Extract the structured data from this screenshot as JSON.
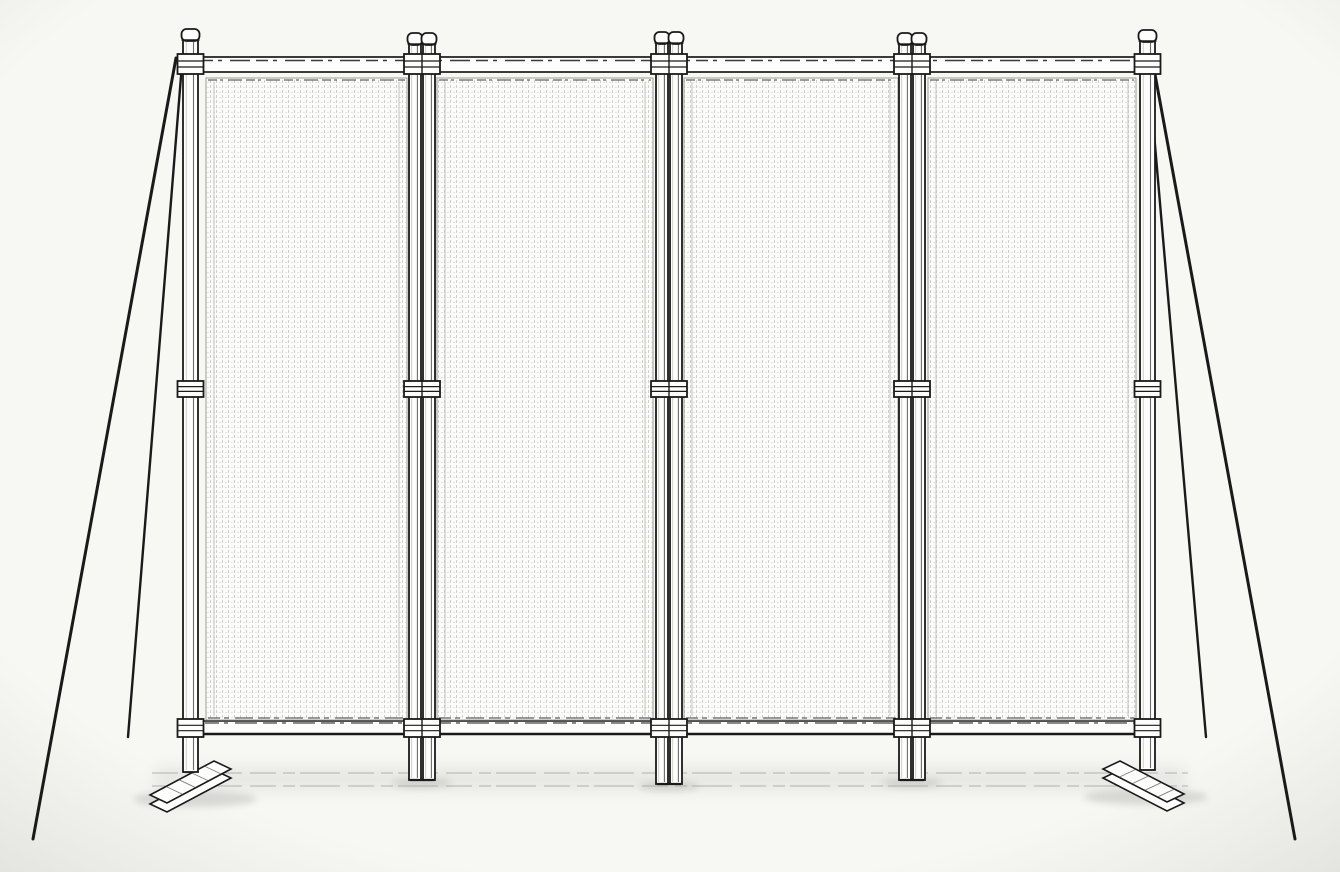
{
  "scene": {
    "subject": "Line drawing of a freestanding four-panel privacy screen fence with twin intermediate posts, corner guy wires and flat T-feet",
    "canvas": {
      "width": 1340,
      "height": 872
    },
    "colors": {
      "background": "#f7f7f4",
      "background_edge": "#a8a89e",
      "ink": "#1a1a1a",
      "ink_soft": "#3c3c3c",
      "metal_fill": "#fdfdfc",
      "panel_fill": "#fcfcfa",
      "mesh_dot": "#cfcfcb",
      "mesh_dot_light": "#e2e2de",
      "panel_border": "#9b9b97",
      "hem_line": "#c2c2be",
      "ground_line": "#a8a8a4",
      "shadow": "#9c9c98"
    },
    "structure": {
      "top_rail": {
        "x1": 197,
        "x2": 1143,
        "y": 57,
        "height": 15
      },
      "bottom_rail": {
        "x1": 201,
        "x2": 1139,
        "y": 721,
        "height": 13
      },
      "panels": [
        {
          "x1": 206,
          "x2": 407,
          "y1": 78,
          "y2": 720
        },
        {
          "x1": 437,
          "x2": 653,
          "y1": 78,
          "y2": 720
        },
        {
          "x1": 684,
          "x2": 898,
          "y1": 78,
          "y2": 720
        },
        {
          "x1": 928,
          "x2": 1136,
          "y1": 78,
          "y2": 720
        }
      ],
      "posts": [
        {
          "id": "left-end",
          "type": "single",
          "x": 183,
          "width": 15,
          "cap_y": 27,
          "bottom_y": 772
        },
        {
          "id": "middle-1",
          "type": "twin",
          "x": 409,
          "width": 26,
          "cap_y": 31,
          "bottom_y": 780
        },
        {
          "id": "middle-2",
          "type": "twin",
          "x": 656,
          "width": 26,
          "cap_y": 30,
          "bottom_y": 784
        },
        {
          "id": "middle-3",
          "type": "twin",
          "x": 899,
          "width": 26,
          "cap_y": 31,
          "bottom_y": 780
        },
        {
          "id": "right-end",
          "type": "single",
          "x": 1140,
          "width": 15,
          "cap_y": 28,
          "bottom_y": 770
        }
      ],
      "clamp_rows": [
        {
          "y": 54,
          "h": 20
        },
        {
          "y": 381,
          "h": 16
        },
        {
          "y": 719,
          "h": 18
        }
      ],
      "guy_wires": [
        {
          "id": "left-outer",
          "x1": 176,
          "y1": 58,
          "x2": 33,
          "y2": 839
        },
        {
          "id": "left-inner",
          "x1": 182,
          "y1": 64,
          "x2": 128,
          "y2": 737
        },
        {
          "id": "right-outer",
          "x1": 1152,
          "y1": 58,
          "x2": 1295,
          "y2": 839
        },
        {
          "id": "right-inner",
          "x1": 1148,
          "y1": 64,
          "x2": 1206,
          "y2": 737
        }
      ],
      "feet": [
        {
          "id": "left",
          "top_face": [
            [
              150,
              795
            ],
            [
              214,
              761
            ],
            [
              231,
              769
            ],
            [
              167,
              803
            ]
          ],
          "thickness": 9
        },
        {
          "id": "right",
          "top_face": [
            [
              1120,
              761
            ],
            [
              1184,
              794
            ],
            [
              1167,
              802
            ],
            [
              1103,
              769
            ]
          ],
          "thickness": 9
        }
      ],
      "ground": {
        "lines": [
          {
            "x1": 152,
            "x2": 1188,
            "y": 773
          },
          {
            "x1": 152,
            "x2": 1188,
            "y": 786
          }
        ],
        "shadow_spots": [
          {
            "cx": 195,
            "cy": 799,
            "rx": 62,
            "ry": 8
          },
          {
            "cx": 422,
            "cy": 783,
            "rx": 30,
            "ry": 5
          },
          {
            "cx": 669,
            "cy": 786,
            "rx": 30,
            "ry": 5
          },
          {
            "cx": 912,
            "cy": 783,
            "rx": 30,
            "ry": 5
          },
          {
            "cx": 1146,
            "cy": 797,
            "rx": 62,
            "ry": 8
          }
        ],
        "shadow_band": {
          "x1": 155,
          "x2": 1185,
          "y": 766,
          "h": 26
        }
      }
    }
  }
}
